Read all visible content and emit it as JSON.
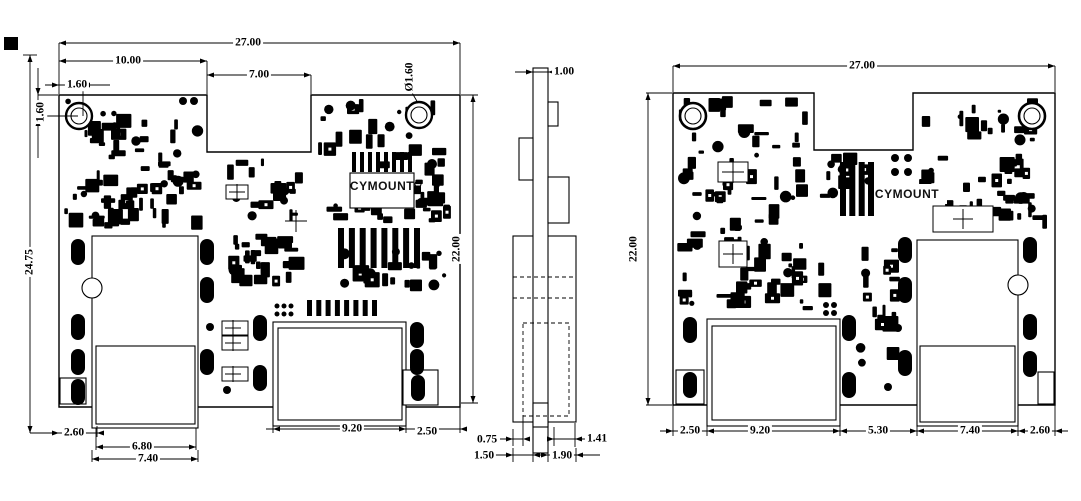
{
  "drawing": {
    "views": {
      "top_view": {
        "silkscreen": "CYMOUNT",
        "dims": {
          "overall_width": "27.00",
          "left_width": "10.00",
          "notch_width": "7.00",
          "hole_offset_x": "1.60",
          "hole_offset_y": "1.60",
          "hole_diameter": "Ø1.60",
          "total_height": "24.75",
          "board_height": "22.00",
          "bottom_left_margin": "2.60",
          "left_slot_inner_width": "6.80",
          "left_slot_width": "7.40",
          "right_slot_width": "9.20",
          "bottom_right_margin": "2.50"
        }
      },
      "side_view": {
        "dims": {
          "board_thickness": "1.00",
          "offset_a": "0.75",
          "offset_b": "1.41",
          "offset_c": "1.50",
          "offset_d": "1.90"
        }
      },
      "bottom_view": {
        "silkscreen": "CYMOUNT",
        "dims": {
          "overall_width": "27.00",
          "board_height": "22.00",
          "left_margin": "2.50",
          "left_slot_width": "9.20",
          "center_width": "5.30",
          "right_slot_width": "7.40",
          "right_margin": "2.60"
        }
      }
    },
    "colors": {
      "ink": "#000000",
      "paper": "#ffffff"
    }
  }
}
